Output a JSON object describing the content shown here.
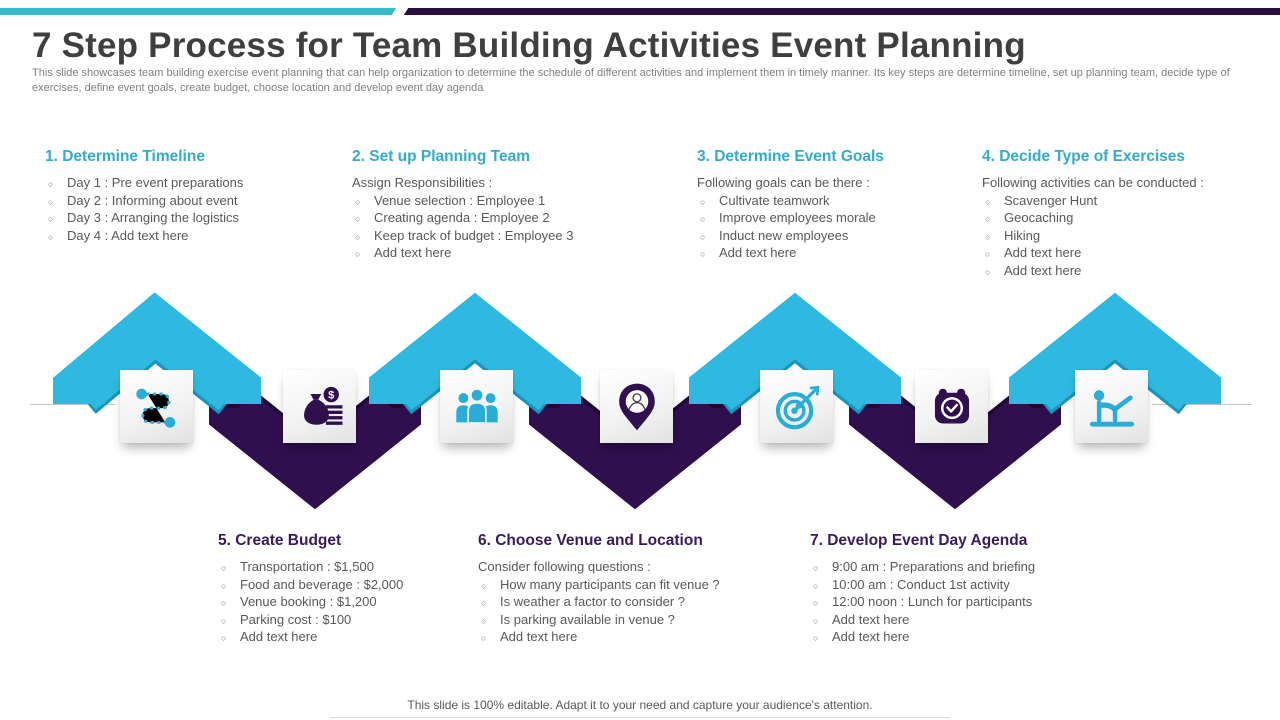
{
  "slide": {
    "title": "7 Step Process for Team Building Activities Event Planning",
    "subtitle": "This slide showcases team building exercise event planning that can help organization to determine the schedule of different activities and implement them in timely manner. Its key steps are determine timeline, set up planning team, decide type  of exercises, define event goals, create budget, choose location and develop event day agenda",
    "footer": "This slide is 100% editable. Adapt it to your need and capture your audience's attention."
  },
  "colors": {
    "ribbon_teal": "#2fb9e0",
    "ribbon_teal_dark": "#1796bc",
    "ribbon_purple": "#2f0f4d",
    "ribbon_purple_dark": "#1d0733",
    "heading_teal": "#2fadc9",
    "heading_purple": "#3a1a5b",
    "topbar_teal": "#38bac8",
    "topbar_purple": "#2a0e3f",
    "title_gray": "#3f3f3f",
    "body_gray": "#595959"
  },
  "icons": [
    "route-timeline-icon",
    "money-bag-icon",
    "team-icon",
    "location-pin-icon",
    "target-icon",
    "calendar-clock-icon",
    "exercise-icon"
  ],
  "steps": [
    {
      "title": "1. Determine Timeline",
      "intro": "",
      "items": [
        "Day 1 : Pre event preparations",
        "Day 2 : Informing about event",
        "Day 3 : Arranging  the logistics",
        "Day 4 : Add text here"
      ]
    },
    {
      "title": "2. Set up Planning Team",
      "intro": "Assign Responsibilities :",
      "items": [
        "Venue selection : Employee 1",
        "Creating agenda : Employee 2",
        "Keep track of budget : Employee 3",
        "Add text here"
      ]
    },
    {
      "title": "3. Determine Event Goals",
      "intro": "Following goals can be there :",
      "items": [
        "Cultivate teamwork",
        "Improve employees morale",
        "Induct new employees",
        "Add text here"
      ]
    },
    {
      "title": "4. Decide Type of Exercises",
      "intro": "Following activities can be conducted :",
      "items": [
        "Scavenger Hunt",
        "Geocaching",
        "Hiking",
        "Add text here",
        "Add text here"
      ]
    },
    {
      "title": "5. Create Budget",
      "intro": "",
      "items": [
        "Transportation : $1,500",
        "Food and beverage  : $2,000",
        "Venue booking  : $1,200",
        "Parking cost : $100",
        "Add text here"
      ]
    },
    {
      "title": "6. Choose Venue and Location",
      "intro": "Consider following questions :",
      "items": [
        "How many participants can fit venue ?",
        "Is weather a factor to consider ?",
        "Is parking available  in venue ?",
        "Add text here"
      ]
    },
    {
      "title": "7. Develop Event Day Agenda",
      "intro": "",
      "items": [
        "9:00 am : Preparations and briefing",
        "10:00 am : Conduct 1st activity",
        "12:00 noon : Lunch for participants",
        "Add text here",
        "Add text here"
      ]
    }
  ]
}
